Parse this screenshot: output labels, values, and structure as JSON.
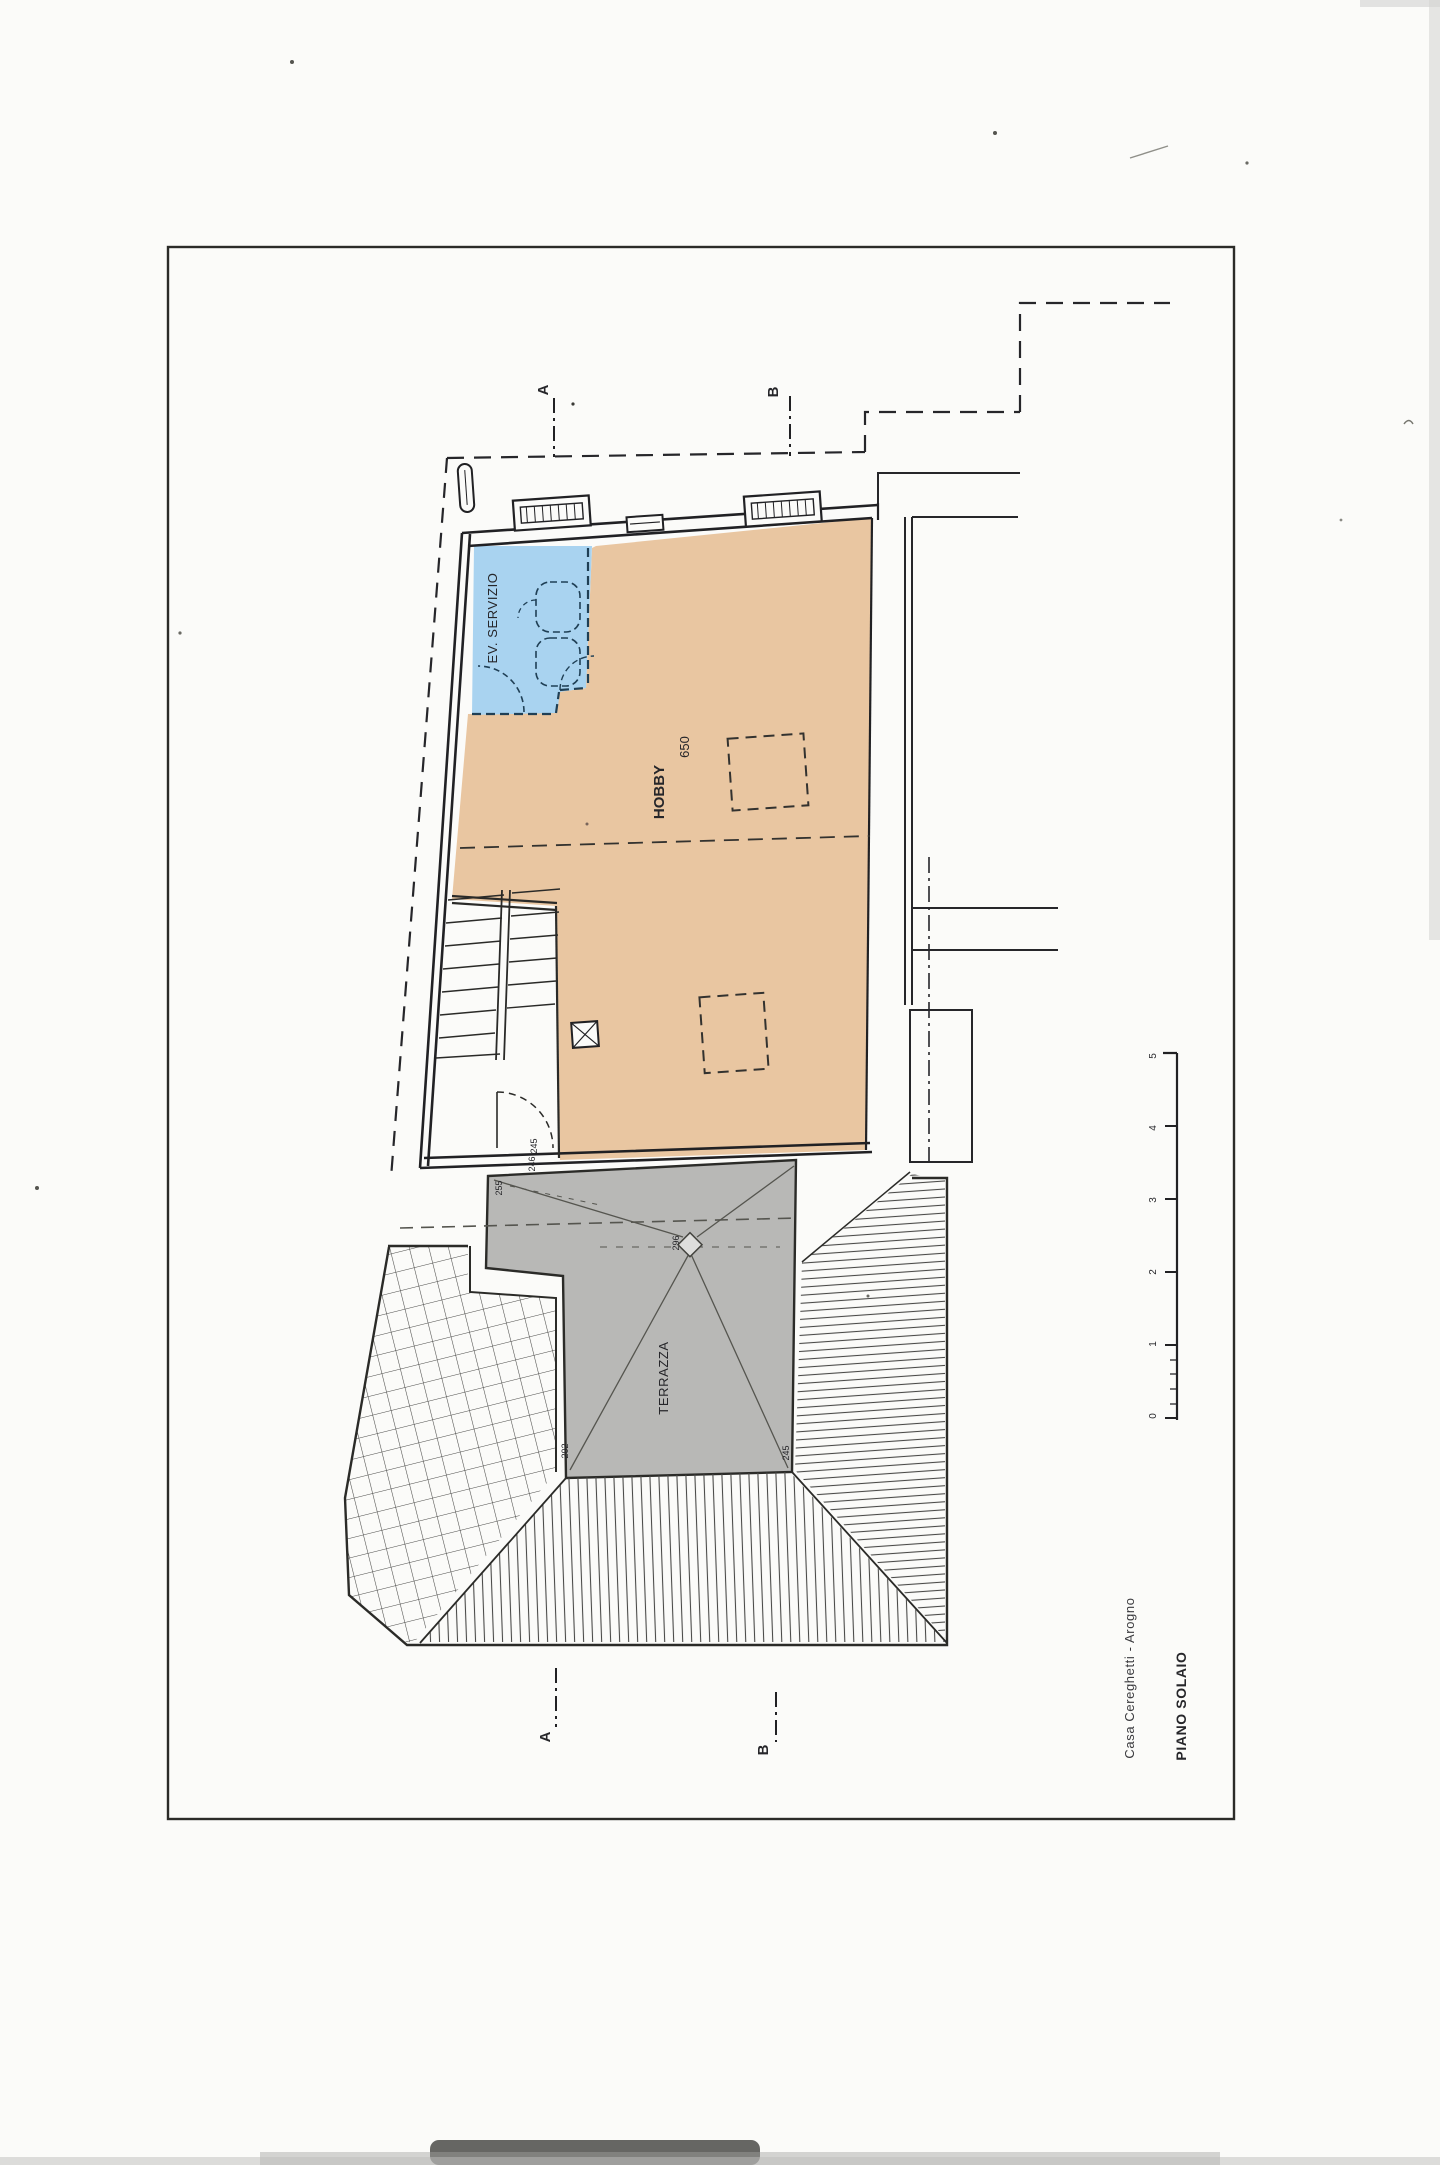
{
  "page": {
    "paper": "#fbfbf9"
  },
  "colors": {
    "line": "#2b2b28",
    "blue_room": "#a9d3f0",
    "hobby_room": "#e9c6a1",
    "terrace": "#b8b8b6",
    "hatch": "#4a4a48"
  },
  "plan": {
    "rooms": {
      "servizio": {
        "label": "EV. SERVIZIO"
      },
      "hobby": {
        "label": "HOBBY",
        "area": "650"
      },
      "terrazza": {
        "label": "TERRAZZA"
      }
    },
    "sections": {
      "a": "A",
      "b": "B"
    },
    "dimensions": {
      "terrace_tl": "255",
      "terrace_drain": "296",
      "terrace_bl": "202",
      "terrace_br": "245",
      "door_top": "245",
      "door_bottom": "246"
    },
    "scale_ticks": [
      "5",
      "4",
      "3",
      "2",
      "1",
      "0"
    ]
  },
  "titleblock": {
    "project": "Casa Cereghetti - Arogno",
    "sheet": "PIANO SOLAIO"
  }
}
